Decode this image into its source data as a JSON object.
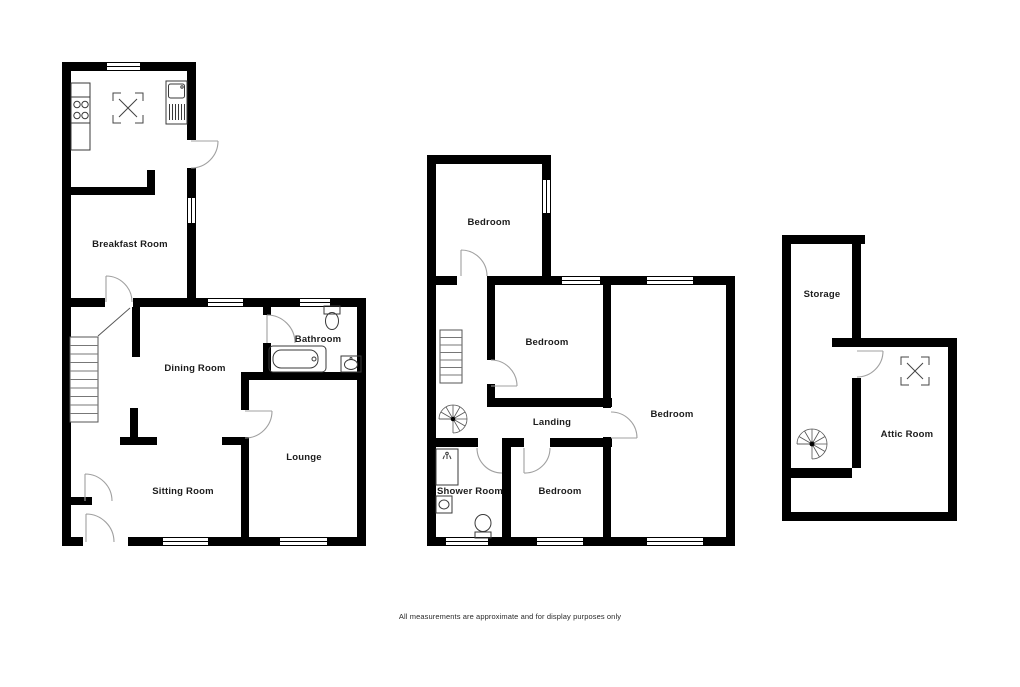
{
  "footer": {
    "text": "All measurements are approximate and for display purposes only"
  },
  "colors": {
    "background": "#ffffff",
    "walls": "#000000",
    "fixtures": "#3a3a3a",
    "door_arcs": "#a0a0a0",
    "text": "#1c1c1c"
  },
  "plans": [
    {
      "name": "ground-floor",
      "rooms": [
        {
          "label": "Breakfast Room"
        },
        {
          "label": "Dining Room"
        },
        {
          "label": "Bathroom"
        },
        {
          "label": "Lounge"
        },
        {
          "label": "Sitting Room"
        }
      ],
      "fixtures": [
        "hob-icon",
        "sink-icon",
        "rooflight-icon",
        "staircase-icon",
        "bath-icon",
        "toilet-icon",
        "basin-icon"
      ]
    },
    {
      "name": "first-floor",
      "rooms": [
        {
          "label": "Bedroom"
        },
        {
          "label": "Bedroom"
        },
        {
          "label": "Bedroom"
        },
        {
          "label": "Landing"
        },
        {
          "label": "Bedroom"
        },
        {
          "label": "Shower Room"
        }
      ],
      "fixtures": [
        "staircase-icon",
        "spiral-staircase-icon",
        "shower-icon",
        "basin-icon",
        "toilet-icon"
      ]
    },
    {
      "name": "attic-floor",
      "rooms": [
        {
          "label": "Storage"
        },
        {
          "label": "Attic Room"
        }
      ],
      "fixtures": [
        "spiral-staircase-icon",
        "rooflight-icon"
      ]
    }
  ]
}
